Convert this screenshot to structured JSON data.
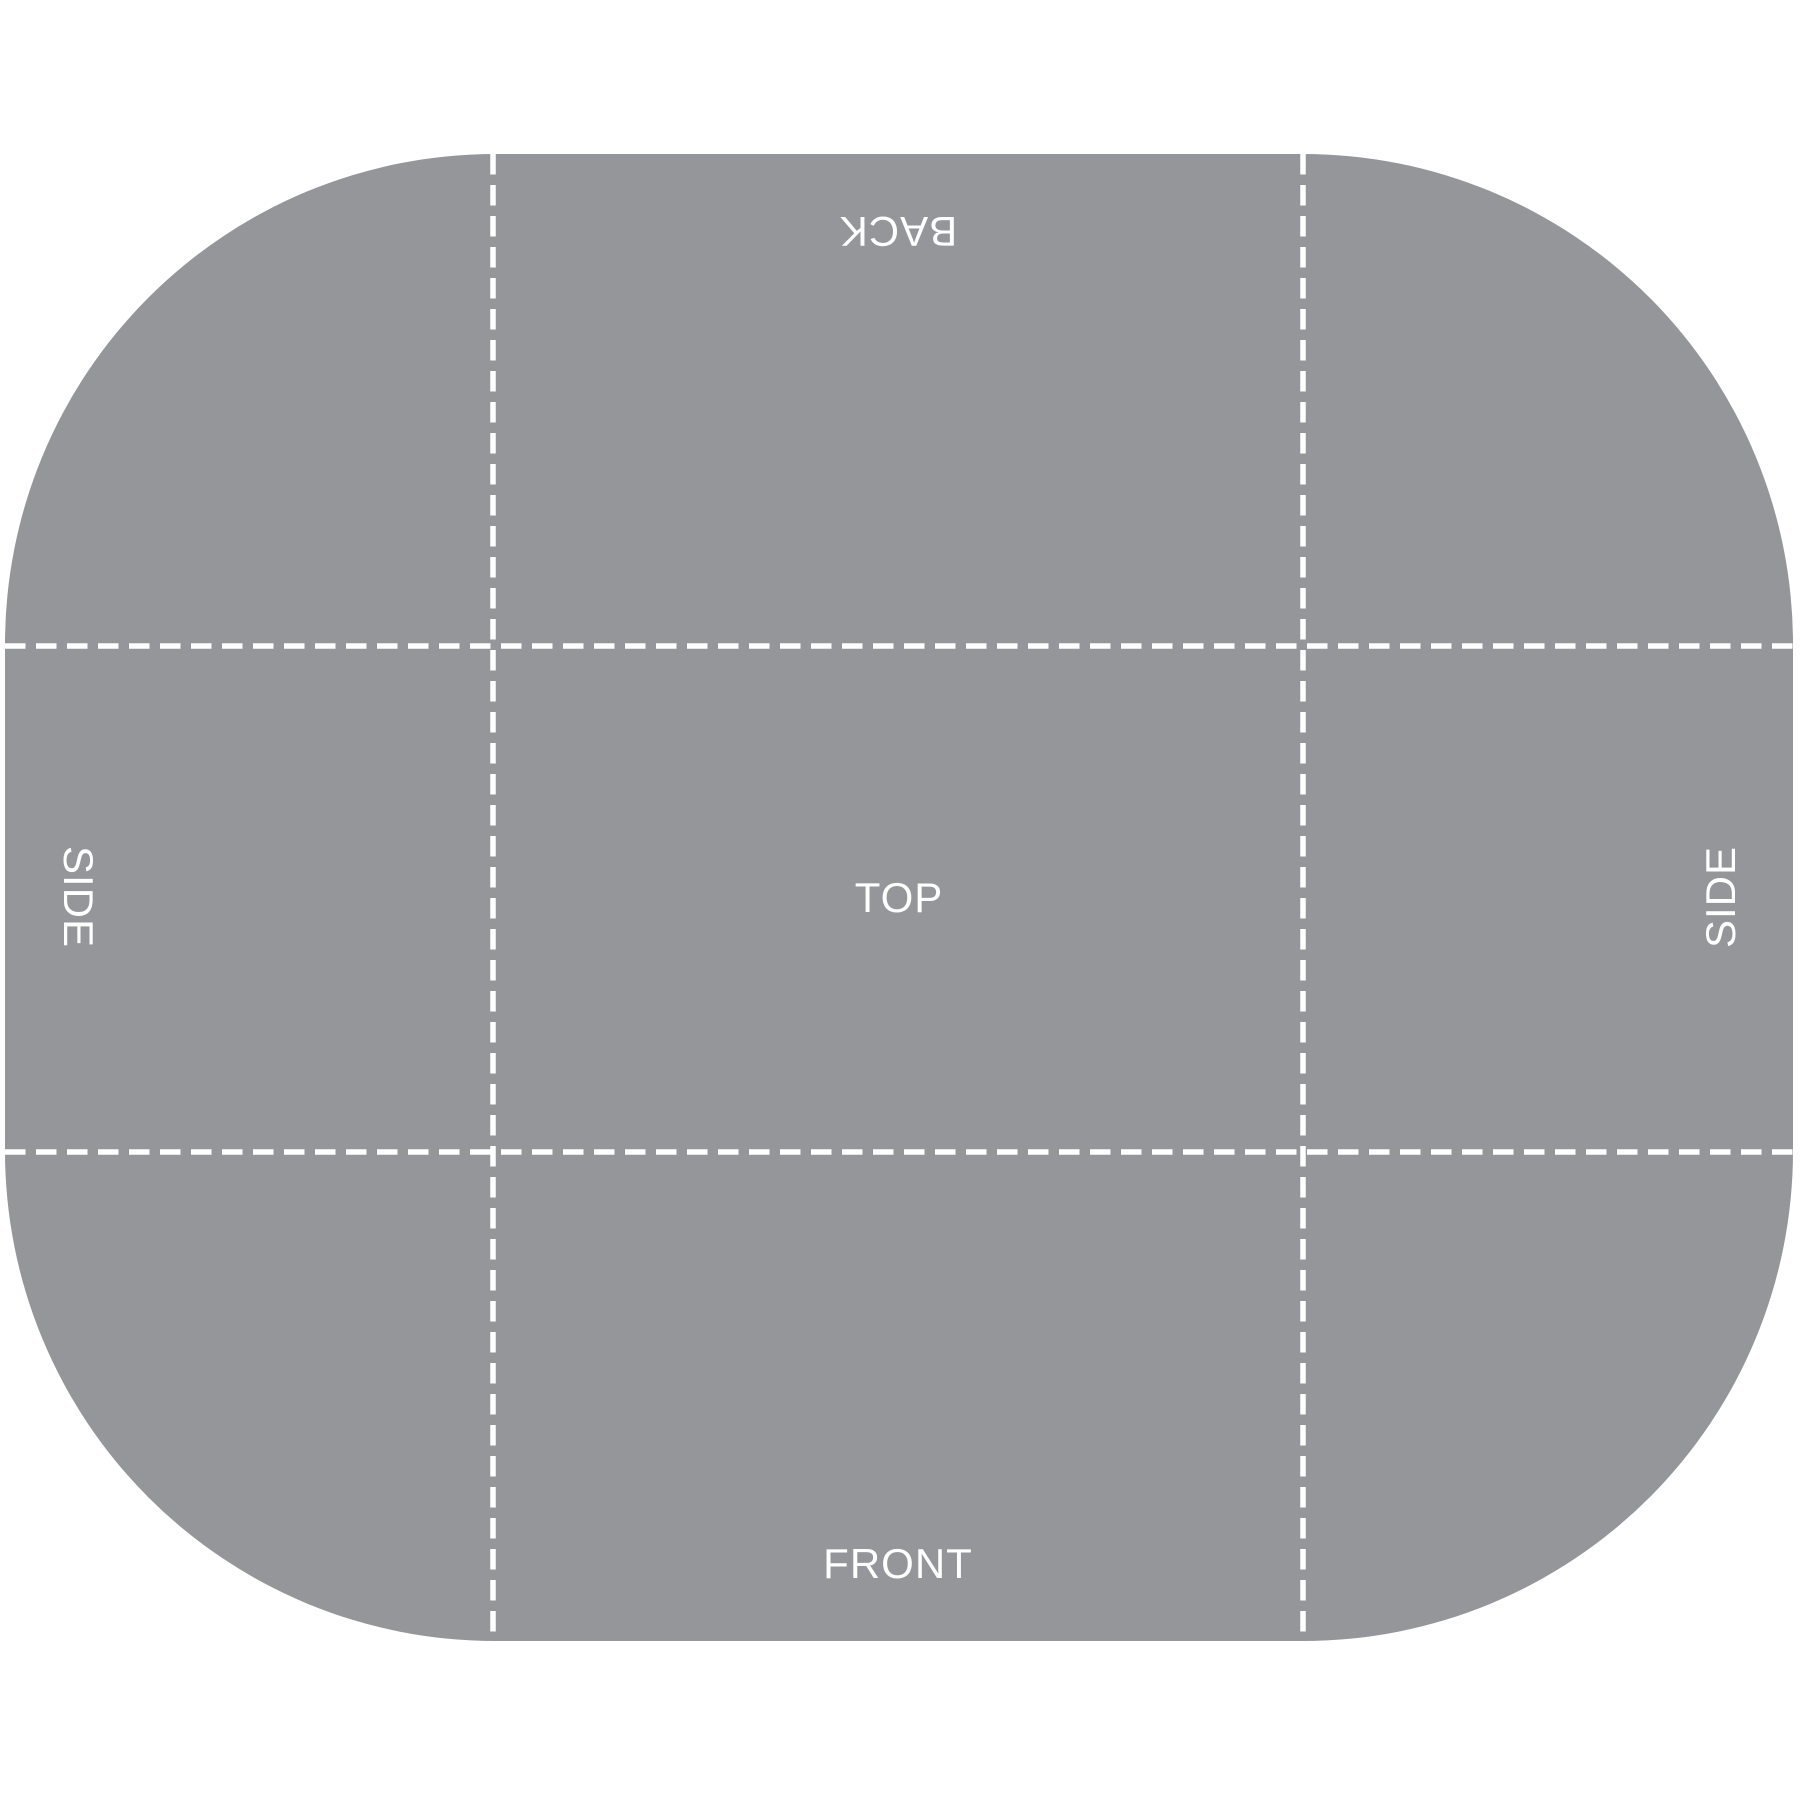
{
  "diagram": {
    "type": "box-dieline-template",
    "labels": {
      "back": "BACK",
      "top": "TOP",
      "front": "FRONT",
      "side_left": "SIDE",
      "side_right": "SIDE"
    }
  },
  "colors": {
    "panel-fill": "#95969A",
    "fold-line": "#FFFFFF",
    "label-color": "#FFFFFF",
    "page-bg": "#FFFFFF"
  }
}
